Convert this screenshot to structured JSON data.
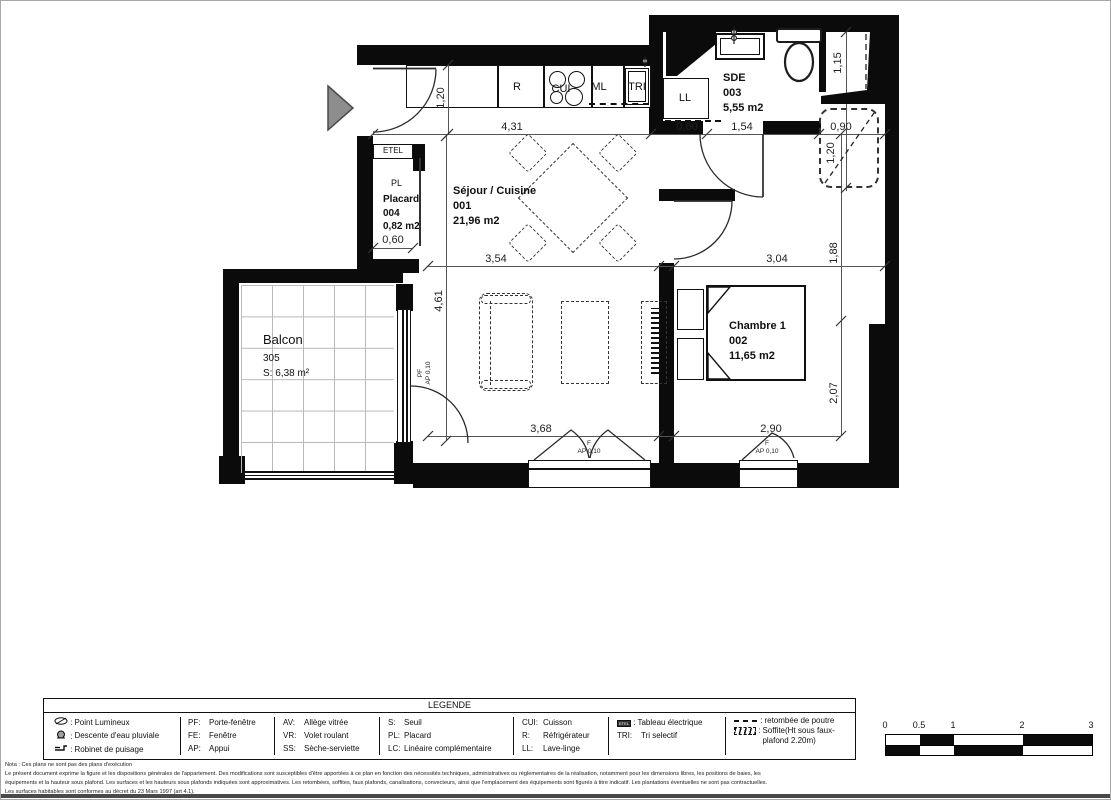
{
  "plan": {
    "rooms": {
      "sejour": {
        "name": "Séjour / Cuisine",
        "number": "001",
        "area": "21,96 m2"
      },
      "sde": {
        "name": "SDE",
        "number": "003",
        "area": "5,55 m2"
      },
      "chambre": {
        "name": "Chambre 1",
        "number": "002",
        "area": "11,65 m2"
      },
      "placard": {
        "tag": "PL",
        "name": "Placard",
        "number": "004",
        "area": "0,82 m2",
        "dim": "0,60"
      },
      "balcon": {
        "name": "Balcon",
        "number": "305",
        "area": "S: 6,38 m²"
      }
    },
    "kitchen": {
      "fridge": "R",
      "cooktop": "CUI",
      "ml": "ML",
      "tri": "TRI"
    },
    "laundry": "LL",
    "electrical_panel": "ETEL",
    "dims": {
      "top_431": "4,31",
      "top_060": "0,60",
      "top_154": "1,54",
      "top_090": "0,90",
      "entry_120": "1,20",
      "shower_115": "1,15",
      "soffit_120": "1,20",
      "mid_354": "3,54",
      "mid_304": "3,04",
      "left_461": "4,61",
      "right_188": "1,88",
      "right_207": "2,07",
      "bot_368": "3,68",
      "bot_290": "2,90"
    },
    "openings": {
      "f": "F",
      "ap": "AP 0,10",
      "pf": "PF"
    }
  },
  "legend": {
    "title": "LEGENDE",
    "col1": [
      {
        "icon": "lamp",
        "label": "Point Lumineux"
      },
      {
        "icon": "rain-downpipe",
        "label": "Descente d'eau pluviale"
      },
      {
        "icon": "tap",
        "label": "Robinet de puisage"
      }
    ],
    "col2": [
      {
        "abbr": "PF",
        "label": "Porte-fenêtre"
      },
      {
        "abbr": "FE",
        "label": "Fenêtre"
      },
      {
        "abbr": "AP",
        "label": "Appui"
      }
    ],
    "col3": [
      {
        "abbr": "AV",
        "label": "Allège vitrée"
      },
      {
        "abbr": "VR",
        "label": "Volet roulant"
      },
      {
        "abbr": "SS",
        "label": "Sèche-serviette"
      }
    ],
    "col4": [
      {
        "abbr": "S",
        "label": "Seuil"
      },
      {
        "abbr": "PL",
        "label": "Placard"
      },
      {
        "abbr": "LC",
        "label": "Linéaire complémentaire"
      }
    ],
    "col5": [
      {
        "abbr": "CUI",
        "label": "Cuisson"
      },
      {
        "abbr": "R",
        "label": "Réfrigérateur"
      },
      {
        "abbr": "LL",
        "label": "Lave-linge"
      }
    ],
    "col6": [
      {
        "abbr": "ETEL",
        "label": "Tableau électrique"
      },
      {
        "abbr": "TRI",
        "label": "Tri selectif"
      }
    ],
    "col7": [
      {
        "icon": "dashes",
        "label": "retombée de poutre"
      },
      {
        "icon": "soffit-hatch",
        "label": "Soffite(Ht sous faux-plafond 2.20m)"
      }
    ]
  },
  "scalebar": {
    "t0": "0",
    "t05": "0.5",
    "t1": "1",
    "t2": "2",
    "t3": "3"
  },
  "notes": {
    "l1": "Nota : Ces plans ne sont pas des plans d'exécution",
    "l2": "Le présent document exprime la figure et les dispositions générales de l'appartement. Des modifications sont susceptibles d'être apportées à ce plan en fonction des nécessités techniques, administratives ou réglementaires de la réalisation, notamment pour les dimensions libres, les positions de baies, les",
    "l3": "équipements et la hauteur sous plafond. Les surfaces et les hauteurs sous plafonds indiquées sont approximatives. Les retombées, soffites, faux plafonds, canalisations, convecteurs, ainsi que l'emplacement des équipements sont figurés à titre indicatif. Les plantations éventuelles ne sont pas contractuelles.",
    "l4": "Les surfaces habitables sont conformes au décret du 23 Mars 1997 (art 4.1)."
  }
}
